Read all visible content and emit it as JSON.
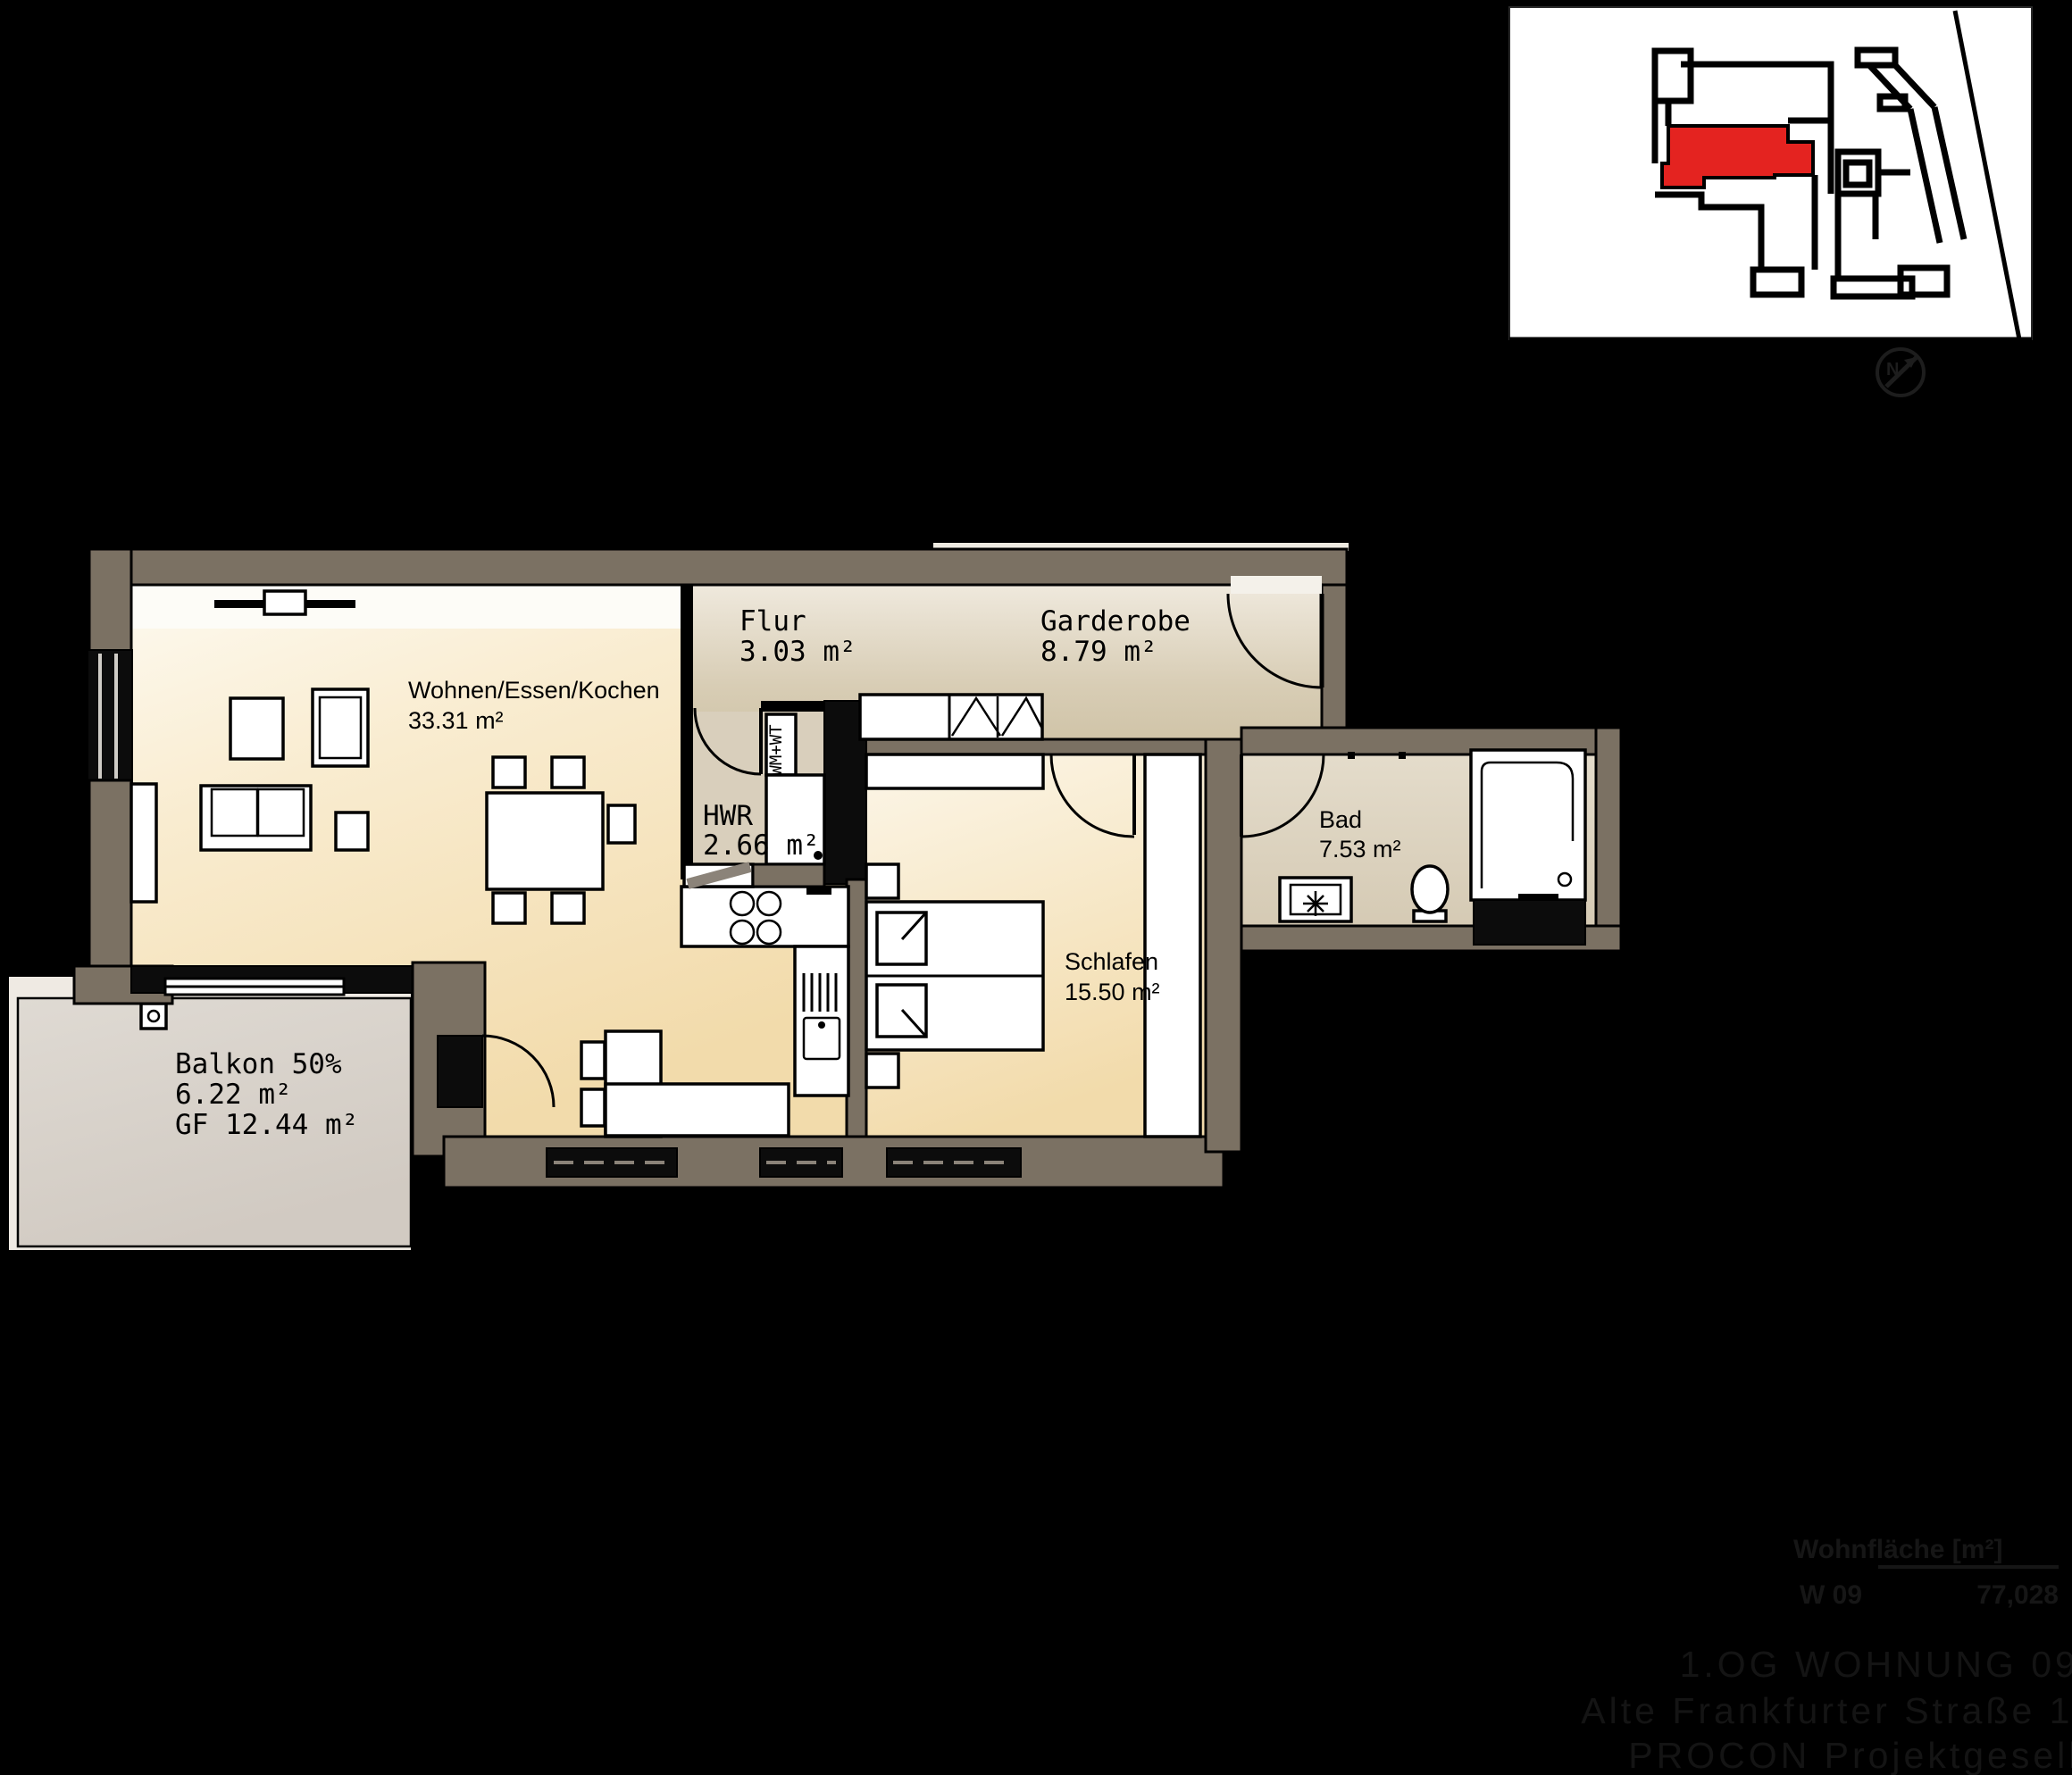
{
  "colors": {
    "background": "#000000",
    "wall": "#7b7163",
    "unit_highlight": "#e42320",
    "room_warm": "#f3dcae",
    "room_gray": "#d6cbb2",
    "balcony": "#d6d0c9"
  },
  "rooms": [
    {
      "key": "wohnen",
      "name": "Wohnen/Essen/Kochen",
      "area": "33.31 m²"
    },
    {
      "key": "flur",
      "name": "Flur",
      "area": "3.03 m²"
    },
    {
      "key": "garderobe",
      "name": "Garderobe",
      "area": "8.79 m²"
    },
    {
      "key": "hwr",
      "name": "HWR",
      "area": "2.66 m²"
    },
    {
      "key": "schlafen",
      "name": "Schlafen",
      "area": "15.50 m²"
    },
    {
      "key": "bad",
      "name": "Bad",
      "area": "7.53 m²"
    },
    {
      "key": "balkon",
      "name": "Balkon 50%",
      "area": "6.22 m²",
      "area_gf": "GF 12.44 m²"
    }
  ],
  "labels": {
    "appliances": "WM+WT",
    "compass": "N"
  },
  "area_table": {
    "header": "Wohnfläche [m²]",
    "rows": [
      {
        "unit": "W 09",
        "value": "77,028"
      }
    ]
  },
  "title_block": {
    "line1": "1.OG WOHNUNG 09 M.1:100",
    "line2": "Alte Frankfurter Straße 102, Bad Vilbel",
    "line3": "PROCON Projektgesellschaft mbH"
  }
}
